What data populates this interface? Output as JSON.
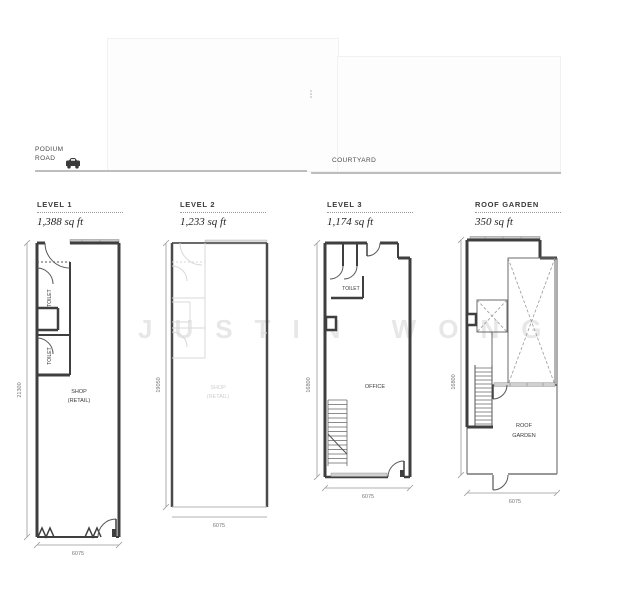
{
  "site": {
    "road_line1": "PODIUM",
    "road_line2": "ROAD",
    "courtyard_label": "COURTYARD",
    "watermark": "JUSTIN WONG"
  },
  "plans": [
    {
      "title": "LEVEL 1",
      "area": "1,388 sq ft",
      "height_dim": "21300",
      "width_dim": "6075",
      "labels": {
        "toilet_upper": "TOILET",
        "toilet_lower": "TOILET",
        "shop_line1": "SHOP",
        "shop_line2": "(RETAIL)"
      }
    },
    {
      "title": "LEVEL 2",
      "area": "1,233 sq ft",
      "height_dim": "19050",
      "width_dim": "6075",
      "labels": {
        "ghost_line1": "SHOP",
        "ghost_line2": "(RETAIL)"
      }
    },
    {
      "title": "LEVEL 3",
      "area": "1,174 sq ft",
      "height_dim": "16800",
      "width_dim": "6075",
      "labels": {
        "toilet": "TOILET",
        "office": "OFFICE"
      }
    },
    {
      "title": "ROOF GARDEN",
      "area": "350 sq ft",
      "height_dim": "16800",
      "width_dim": "6075",
      "labels": {
        "roof_line1": "ROOF",
        "roof_line2": "GARDEN"
      }
    }
  ],
  "colors": {
    "wall": "#3f3f3f",
    "ghost_line": "#d8d8d8",
    "dimension": "#8a8a8a",
    "ground_line": "#bdbdbd",
    "canopy_fill": "#c8c8c8"
  }
}
